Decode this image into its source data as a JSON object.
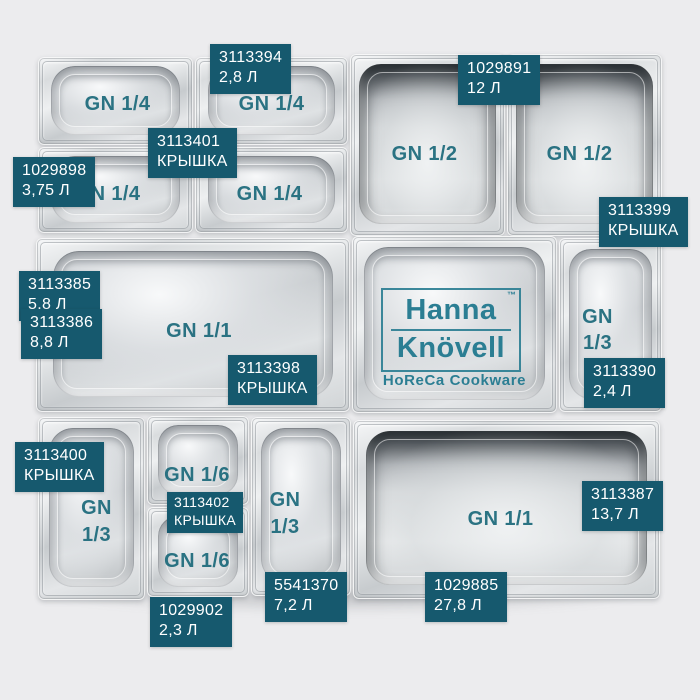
{
  "page": {
    "background_color": "#ececee"
  },
  "colors": {
    "label_background": "#16596e",
    "label_text": "#ffffff",
    "size_text": "#1a687a",
    "logo_teal": "#2b7e93"
  },
  "brand": {
    "line1": "Hanna",
    "tm": "™",
    "line2": "Knövell",
    "tagline": "HoReCa Cookware"
  },
  "pans": [
    {
      "size": "GN 1/4"
    },
    {
      "size": "GN 1/4"
    },
    {
      "size": "GN 1/4"
    },
    {
      "size": "GN 1/4"
    },
    {
      "size": "GN 1/2"
    },
    {
      "size": "GN 1/2"
    },
    {
      "size": "GN 1/1"
    },
    {
      "size": "GN\n1/3"
    },
    {
      "size": "GN\n1/3"
    },
    {
      "size": "GN 1/6"
    },
    {
      "size": "GN 1/6"
    },
    {
      "size": "GN\n1/3"
    },
    {
      "size": "GN 1/1"
    }
  ],
  "labels": [
    {
      "code": "3113394",
      "value": "2,8 Л"
    },
    {
      "code": "1029891",
      "value": "12 Л"
    },
    {
      "code": "3113401",
      "value": "КРЫШКА"
    },
    {
      "code": "1029898",
      "value": "3,75 Л"
    },
    {
      "code": "3113399",
      "value": "КРЫШКА"
    },
    {
      "code": "3113385",
      "value": "5.8 Л"
    },
    {
      "code": "3113386",
      "value": "8,8 Л"
    },
    {
      "code": "3113398",
      "value": "КРЫШКА"
    },
    {
      "code": "3113390",
      "value": "2,4 Л"
    },
    {
      "code": "3113400",
      "value": "КРЫШКА"
    },
    {
      "code": "3113402",
      "value": "КРЫШКА"
    },
    {
      "code": "1029902",
      "value": "2,3 Л"
    },
    {
      "code": "5541370",
      "value": "7,2 Л"
    },
    {
      "code": "1029885",
      "value": "27,8 Л"
    },
    {
      "code": "3113387",
      "value": "13,7 Л"
    }
  ]
}
